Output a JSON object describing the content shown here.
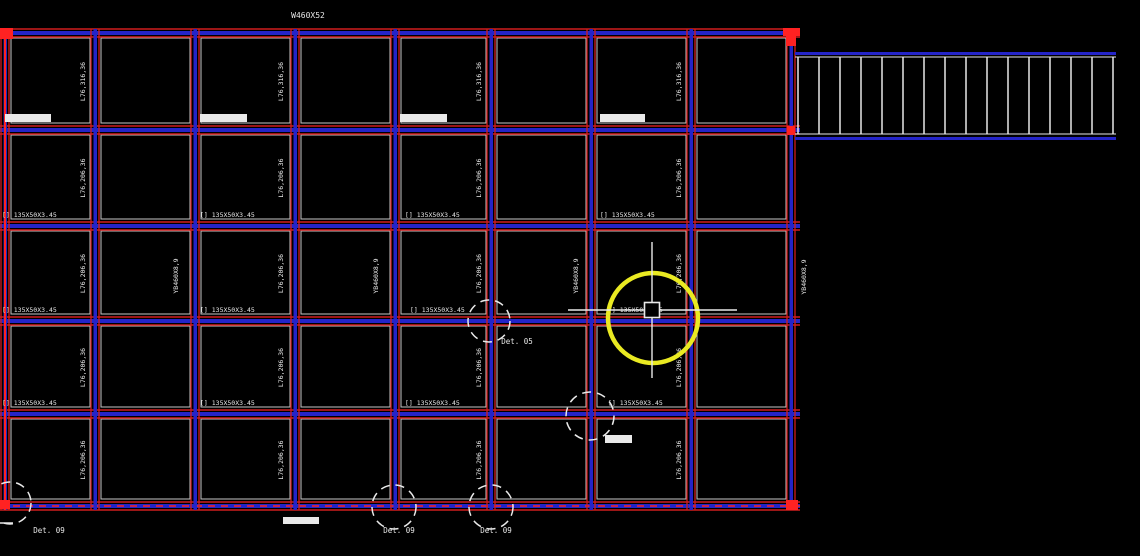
{
  "app": {
    "description": "CAD structural steel framing plan viewport",
    "background": "#000000"
  },
  "colors": {
    "red": "#cf1d1d",
    "red_bright": "#ff2222",
    "blue": "#2424c8",
    "white": "#e9e9e9",
    "yellow": "#eaea22",
    "text": "#e6e6e6"
  },
  "labels": {
    "top_beam": "W460X52",
    "angle_row1": "L76,316,36",
    "angle": "L76,206,36",
    "crane_beam": "YB460X8,9",
    "purlin": "[] 135X50X3.45",
    "det05": "Det. 05",
    "det09": "Det. 09"
  },
  "drawing": {
    "grid": {
      "cols": [
        5,
        95,
        195,
        295,
        395,
        491,
        591,
        691,
        791
      ],
      "rows": [
        33,
        130,
        226,
        321,
        414,
        506
      ],
      "beam_x0": 0,
      "beam_x1": 800,
      "col_y0": 29,
      "col_y1": 510
    },
    "top_label": {
      "x": 308,
      "y": 18
    },
    "angle_label_xs": [
      85,
      283,
      481,
      681
    ],
    "crane_labels": [
      {
        "x": 178,
        "y": 276
      },
      {
        "x": 378,
        "y": 276
      },
      {
        "x": 578,
        "y": 276
      },
      {
        "x": 806,
        "y": 277
      }
    ],
    "purlin_rows": [
      {
        "y": 226,
        "xs": [
          2,
          200,
          405,
          600
        ]
      },
      {
        "y": 321,
        "xs": [
          2,
          200,
          410,
          608
        ]
      },
      {
        "y": 414,
        "xs": [
          2,
          200,
          405,
          608
        ]
      }
    ],
    "white_bars": [
      [
        5,
        114,
        46,
        8
      ],
      [
        200,
        114,
        47,
        8
      ],
      [
        400,
        114,
        47,
        8
      ],
      [
        600,
        114,
        45,
        8
      ],
      [
        283,
        517,
        36,
        7
      ],
      [
        605,
        435,
        27,
        8
      ]
    ],
    "det_circles": [
      {
        "cx": 489,
        "cy": 321,
        "r": 21
      },
      {
        "cx": 590,
        "cy": 416,
        "r": 24
      },
      {
        "cx": 394,
        "cy": 507,
        "r": 22
      },
      {
        "cx": 491,
        "cy": 507,
        "r": 22
      },
      {
        "cx": 10,
        "cy": 503,
        "r": 21
      }
    ],
    "det_labels": [
      {
        "key": "det05",
        "x": 517,
        "y": 344
      },
      {
        "key": "det09",
        "x": 399,
        "y": 533
      },
      {
        "key": "det09",
        "x": 496,
        "y": 533
      },
      {
        "key": "det09",
        "x": 49,
        "y": 533
      }
    ],
    "det_leader": [
      0,
      523,
      13,
      523
    ],
    "ladder": {
      "x0": 795,
      "x1": 1116,
      "top_chord_y": 52,
      "bottom_chord_y": 137,
      "rung_top": 57,
      "rung_bottom": 134,
      "rung_x0": 798,
      "rung_x1": 1113,
      "rung_count": 16
    },
    "red_markers": [
      [
        0,
        28,
        13,
        11
      ],
      [
        783,
        28,
        17,
        8
      ],
      [
        786,
        34,
        10,
        12
      ],
      [
        786,
        500,
        12,
        10
      ],
      [
        0,
        500,
        10,
        9
      ],
      [
        787,
        126,
        8,
        9
      ]
    ],
    "crosshair": {
      "cx": 652,
      "cy": 310,
      "v_y0": 242,
      "v_y1": 378,
      "h_x0": 568,
      "h_x1": 737,
      "pickbox": 15
    },
    "highlight_circle": {
      "cx": 653,
      "cy": 318,
      "r": 45,
      "stroke_width": 4.5
    }
  }
}
